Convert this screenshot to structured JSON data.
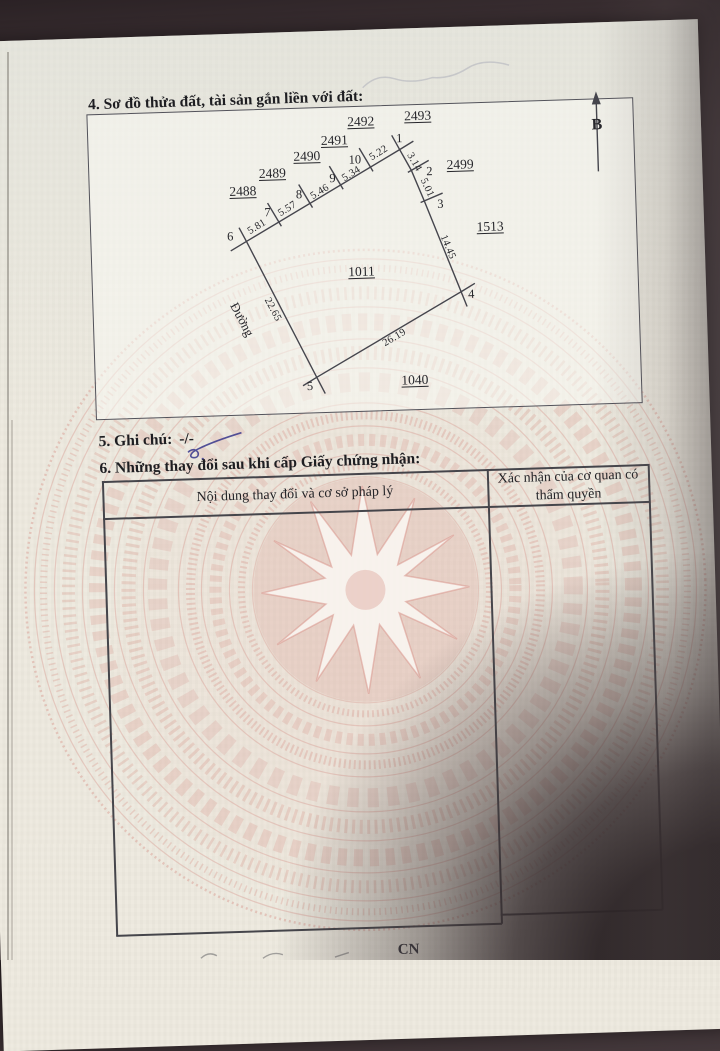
{
  "document": {
    "type_note": "Vietnamese land-use certificate page (photo)",
    "colors": {
      "paper": "#ece8dd",
      "pattern_pink": "#d9a096",
      "ink": "#26262b",
      "pen_blue": "#3d3c8e",
      "background_dark": "#382d30"
    }
  },
  "section4": {
    "title": "4. Sơ đồ thửa đất, tài sản gắn liền với đất:"
  },
  "diagram": {
    "north_label": "B",
    "road_label": "Đường",
    "parcels": [
      "2488",
      "2489",
      "2490",
      "2491",
      "2492",
      "2493",
      "2499",
      "1513",
      "1011",
      "1040"
    ],
    "points": [
      "1",
      "2",
      "3",
      "4",
      "5",
      "6",
      "7",
      "8",
      "9",
      "10"
    ],
    "edges": [
      "5.81",
      "5.57",
      "5.46",
      "5.34",
      "5.22",
      "3.14",
      "5.01",
      "14.45",
      "26.19",
      "22.65"
    ]
  },
  "section5": {
    "title": "5. Ghi chú:",
    "value": "-/-"
  },
  "section6": {
    "title": "6. Những thay đổi sau khi cấp Giấy chứng nhận:",
    "table": {
      "col1_header": "Nội dung thay đổi và cơ sở pháp lý",
      "col2_header": "Xác nhận của cơ quan có thẩm quyền"
    }
  },
  "footer": {
    "partial_text": "CN"
  }
}
